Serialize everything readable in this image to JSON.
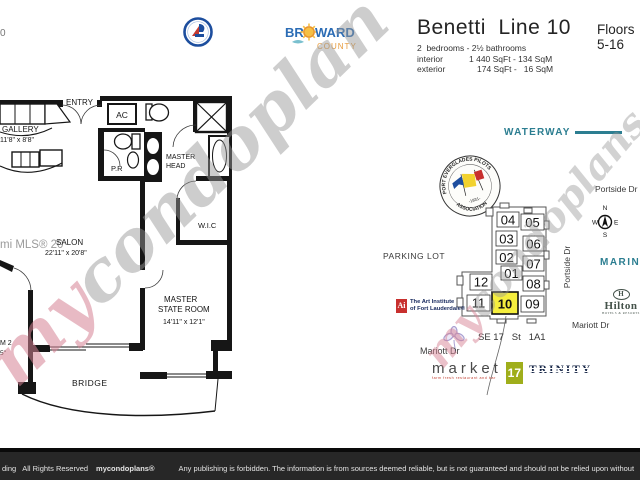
{
  "page": {
    "corner_fragment": "0"
  },
  "colors": {
    "teal": "#2c7e91",
    "highlight_yellow": "#f5ee3e",
    "footer_bg": "#272727",
    "art_institute_red": "#c8302e",
    "market_green": "#9fae1b",
    "trinity_navy": "#1b2a4a"
  },
  "header": {
    "title": "Benetti  Line 10",
    "floors": "Floors 5-16",
    "bed_bath": "2  bedrooms - 2½ bathrooms",
    "interior_label": "interior",
    "interior_value": "1 440 SqFt - 134 SqM",
    "exterior_label": "exterior",
    "exterior_value": "174 SqFt -   16 SqM"
  },
  "logos": {
    "broward": {
      "br": "BR",
      "ward": "WARD",
      "county": "COUNTY"
    },
    "pilots_badge": {
      "arc_top": "PORT EVERGLADES PILOTS",
      "arc_bottom": "ASSOCIATION",
      "year": "-1931-"
    },
    "hilton": {
      "mark": "H",
      "name": "Hilton",
      "tagline": "HOTELS & RESORTS"
    },
    "art_institute": {
      "mark": "Ai",
      "line1": "The Art Institute",
      "line2": "of Fort Lauderdale®"
    },
    "market17": {
      "name": "market",
      "number": "17",
      "tagline": "farm fresh restaurant and bar"
    },
    "trinity": {
      "name": "TRINITY",
      "tagline": "YACHTS"
    }
  },
  "floorplan": {
    "entry": "ENTRY",
    "gallery": "GALLERY",
    "gallery_dim": "11'8\" x 8'8\"",
    "ac": "AC",
    "pr": "P.R",
    "master_head_1": "MASTER",
    "master_head_2": "HEAD",
    "wic": "W.I.C",
    "salon": "SALON",
    "salon_dim": "22'11\" x 20'8\"",
    "master_stateroom_1": "MASTER",
    "master_stateroom_2": "STATE ROOM",
    "master_stateroom_dim": "14'11\" x 12'1\"",
    "stateroom2_fragment": "M 2",
    "stateroom2_dim_fragment": "5\"",
    "bridge": "BRIDGE",
    "mls_watermark": "mi MLS® 20"
  },
  "siteplan": {
    "waterway": "WATERWAY",
    "marina": "MARINA",
    "parking_lot": "PARKING LOT",
    "portside_dr_top": "Portside Dr",
    "portside_dr_side": "Portside Dr",
    "mariott_dr_right": "Mariott Dr",
    "mariott_dr_left": "Mariott Dr",
    "street_label": "SE 17   St   1A1",
    "compass": {
      "n": "N",
      "e": "E",
      "s": "S",
      "w": "W"
    },
    "highlighted_unit": "10",
    "units": [
      {
        "label": "04"
      },
      {
        "label": "05"
      },
      {
        "label": "03"
      },
      {
        "label": "06"
      },
      {
        "label": "02"
      },
      {
        "label": "07"
      },
      {
        "label": "01"
      },
      {
        "label": "08"
      },
      {
        "label": "12"
      },
      {
        "label": "11"
      },
      {
        "label": "10"
      },
      {
        "label": "09"
      }
    ]
  },
  "watermarks": {
    "left_my": "my",
    "left_rest": "condoplan",
    "right_my": "my",
    "right_rest": "condoplans"
  },
  "footer": {
    "left_fragment": "ding",
    "rights": "All Rights Reserved",
    "brand": "mycondoplans®",
    "notice": "Any publishing is forbidden.  The information is from sources deemed reliable, but is not guaranteed and should not be relied upon without"
  }
}
